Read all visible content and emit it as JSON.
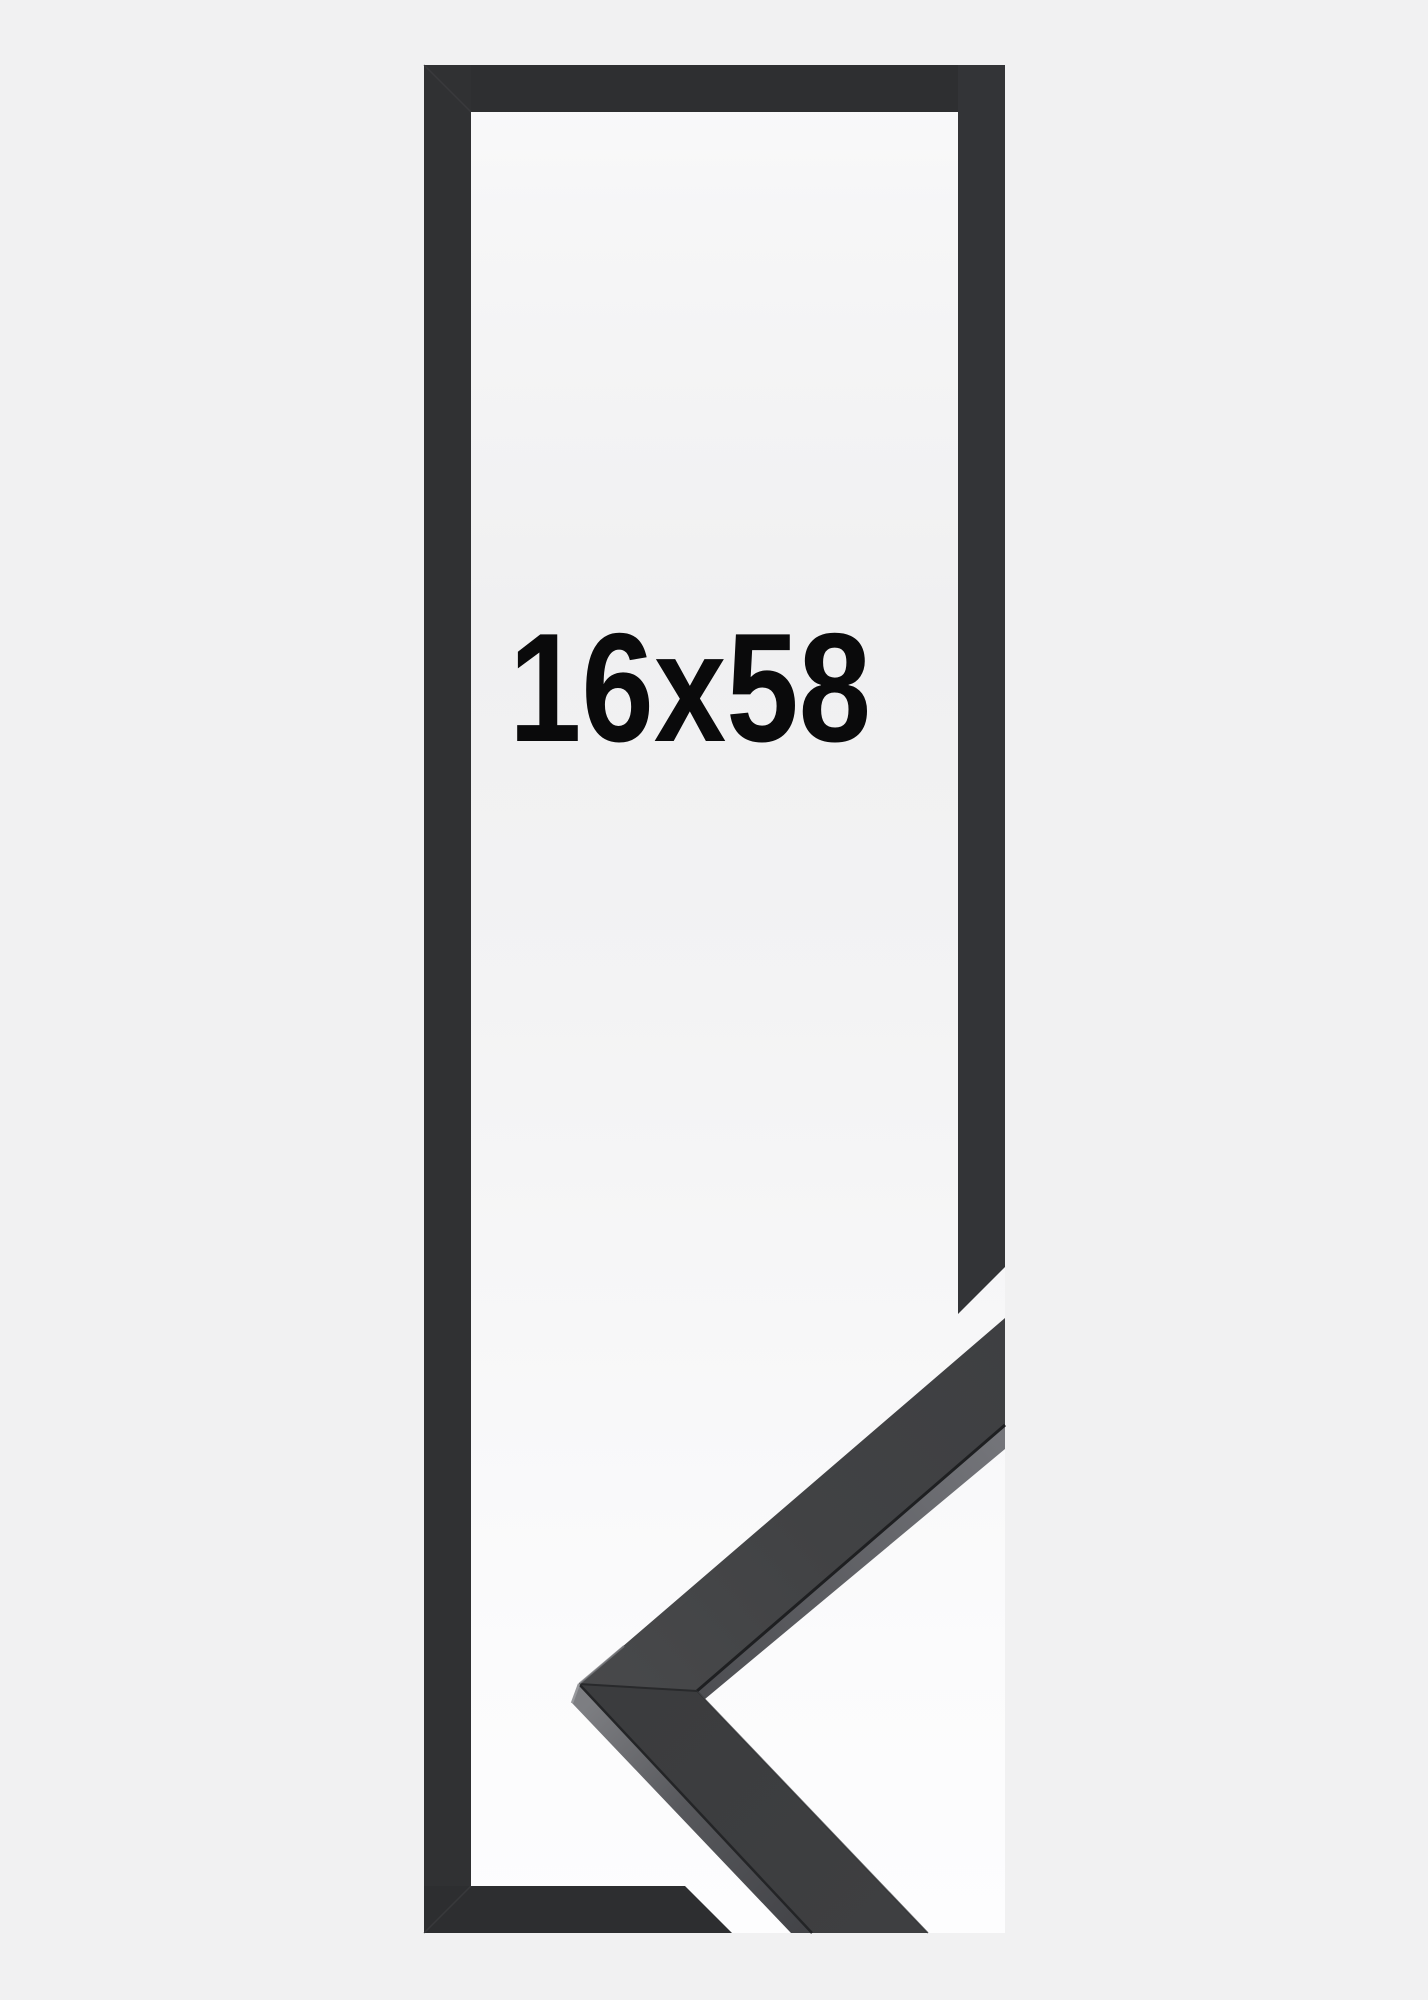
{
  "product": {
    "size_label": "16x58"
  },
  "figure": {
    "description_icons": {
      "frame_outline": "picture-frame-outline",
      "corner_sample": "frame-moulding-corner"
    }
  },
  "colors": {
    "page_background": "#f1f1f2",
    "interior_highlight": "#fcfcfd",
    "interior_mid": "#f0f0f1",
    "frame_bar": "#2e2f31",
    "frame_bar_left": "#303133",
    "frame_bar_right": "#333437",
    "frame_bar_bottom": "#2d2e30",
    "corner_upper_face": "#434446",
    "corner_lower_face": "#3a3b3d",
    "corner_side_face": "#6f7074",
    "label_text": "#0a0a0b"
  }
}
